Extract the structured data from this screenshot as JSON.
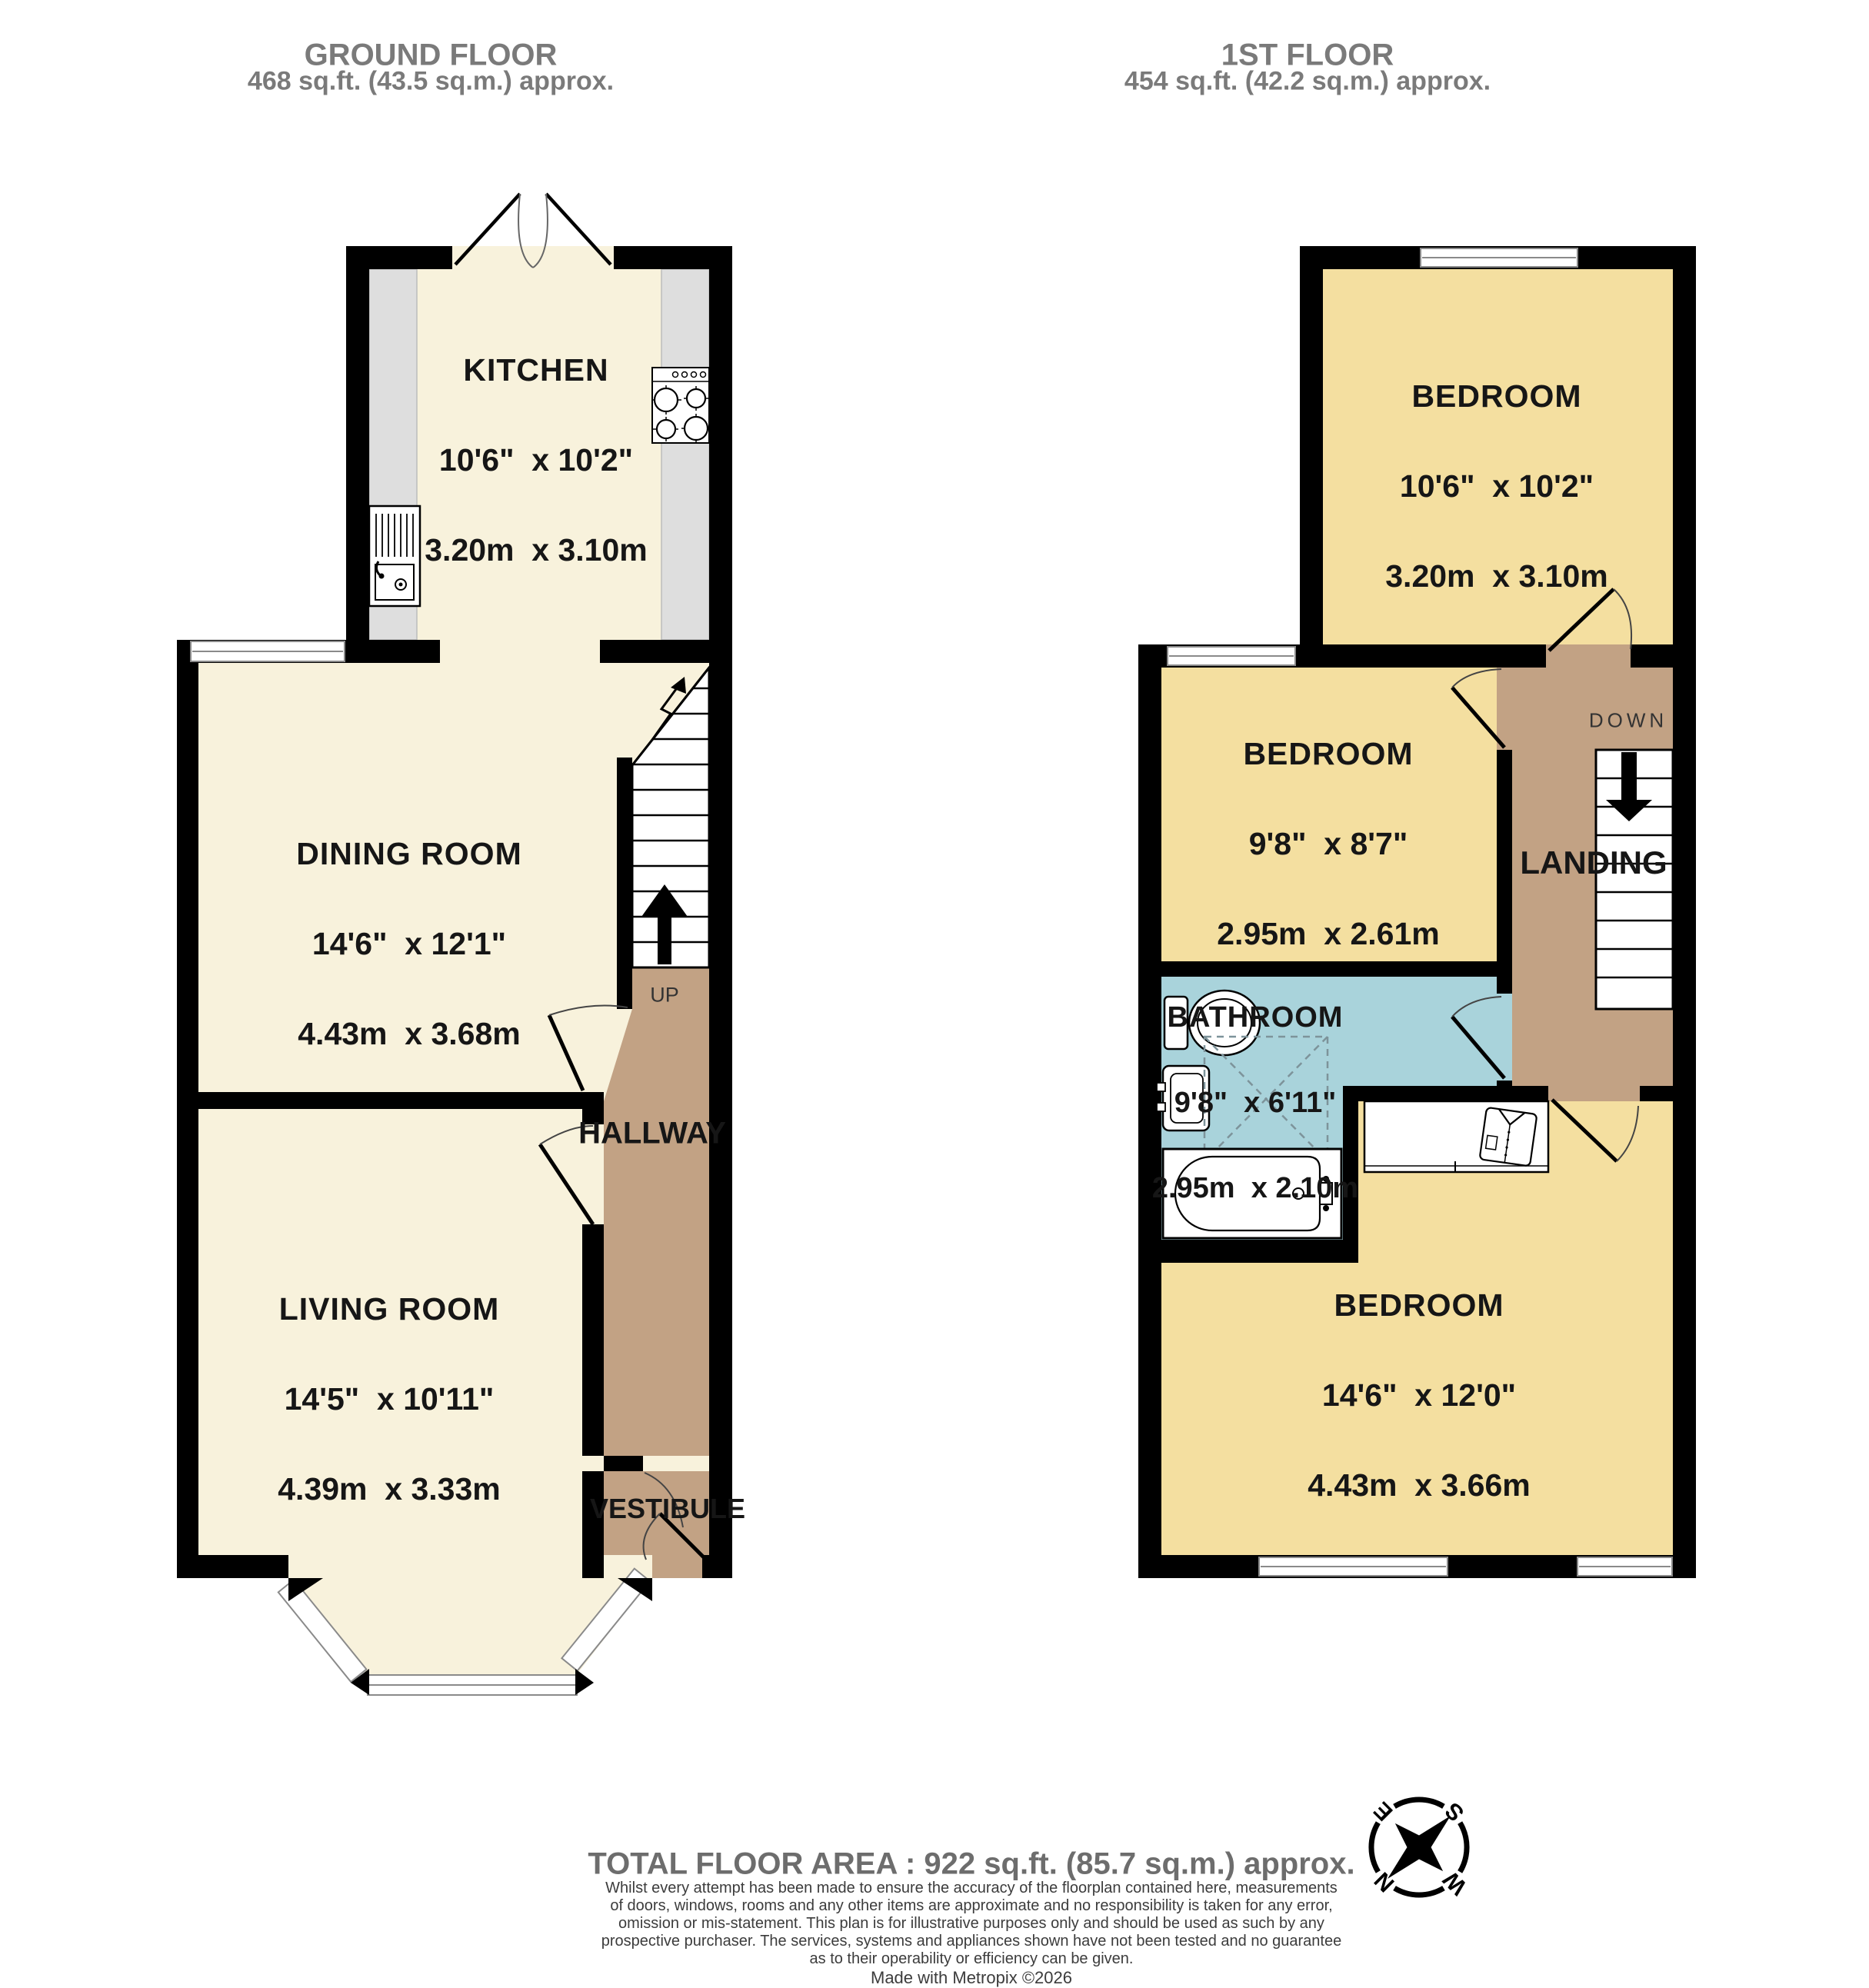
{
  "headers": {
    "ground": {
      "title": "GROUND FLOOR",
      "area": "468 sq.ft. (43.5 sq.m.) approx."
    },
    "first": {
      "title": "1ST FLOOR",
      "area": "454 sq.ft. (42.2 sq.m.) approx."
    }
  },
  "rooms": {
    "kitchen": {
      "name": "KITCHEN",
      "imperial": "10'6\"  x 10'2\"",
      "metric": "3.20m  x 3.10m"
    },
    "dining": {
      "name": "DINING ROOM",
      "imperial": "14'6\"  x 12'1\"",
      "metric": "4.43m  x 3.68m"
    },
    "living": {
      "name": "LIVING ROOM",
      "imperial": "14'5\"  x 10'11\"",
      "metric": "4.39m  x 3.33m"
    },
    "hallway": {
      "name": "HALLWAY"
    },
    "vestibule": {
      "name": "VESTIBULE"
    },
    "bedroom1": {
      "name": "BEDROOM",
      "imperial": "10'6\"  x 10'2\"",
      "metric": "3.20m  x 3.10m"
    },
    "bedroom2": {
      "name": "BEDROOM",
      "imperial": "9'8\"  x 8'7\"",
      "metric": "2.95m  x 2.61m"
    },
    "bathroom": {
      "name": "BATHROOM",
      "imperial": "9'8\"  x 6'11\"",
      "metric": "2.95m  x 2.10m"
    },
    "bedroom3": {
      "name": "BEDROOM",
      "imperial": "14'6\"  x 12'0\"",
      "metric": "4.43m  x 3.66m"
    },
    "landing": {
      "name": "LANDING"
    }
  },
  "stairs": {
    "up": "UP",
    "down": "DOWN"
  },
  "compass": {
    "n": "N",
    "e": "E",
    "s": "S",
    "w": "W"
  },
  "colors": {
    "room_cream": "#f8f2dc",
    "room_gold": "#f4dfa0",
    "circulation_tan": "#c2a284",
    "bathroom_blue": "#a9d3db",
    "counter_gray": "#dedede",
    "wall_black": "#000000"
  },
  "footer": {
    "total": "TOTAL FLOOR AREA : 922 sq.ft. (85.7 sq.m.) approx.",
    "disclaimer": [
      "Whilst every attempt has been made to ensure the accuracy of the floorplan contained here, measurements",
      "of doors, windows, rooms and any other items are approximate and no responsibility is taken for any error,",
      "omission or mis-statement. This plan is for illustrative purposes only and should be used as such by any",
      "prospective purchaser. The services, systems and appliances shown have not been tested and no guarantee",
      "as to their operability or efficiency can be given."
    ],
    "credit": "Made with Metropix ©2026"
  }
}
